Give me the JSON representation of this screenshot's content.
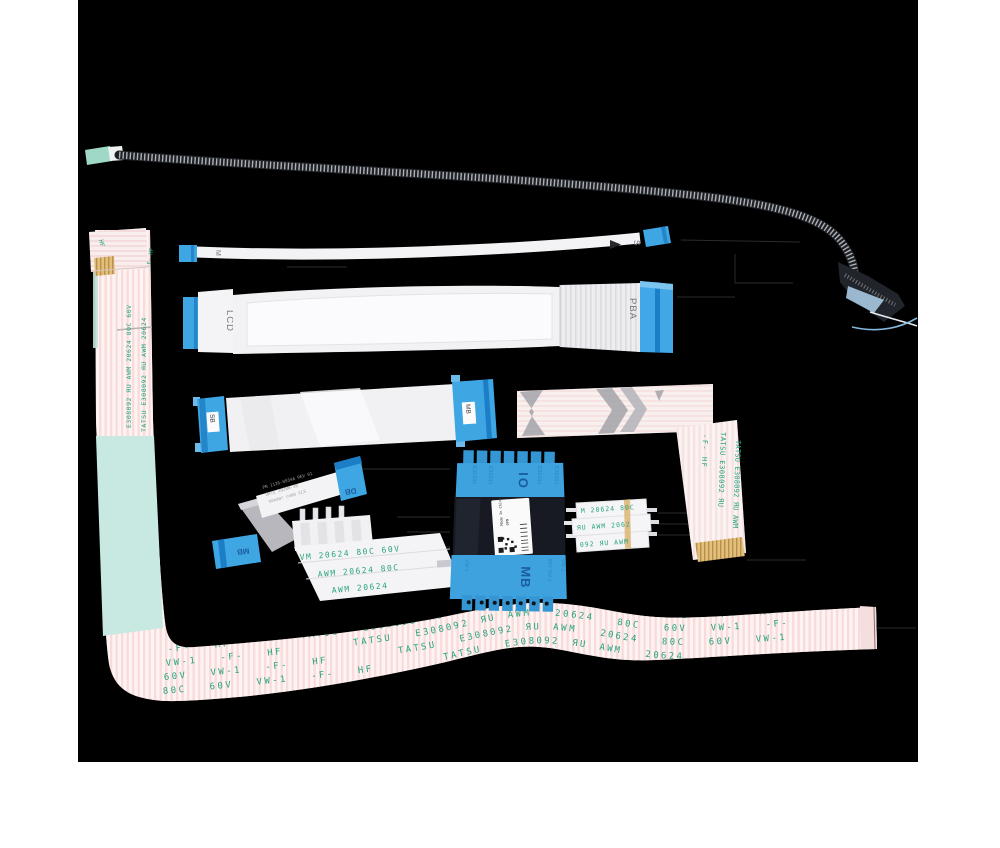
{
  "photo": {
    "background": "#000000",
    "canvas": "#ffffff"
  },
  "colors": {
    "connector_blue": "#3fa6e4",
    "connector_blue_dark": "#1b7ec6",
    "print_green": "#2aa37e",
    "deep_blue_print": "#174f92",
    "mesh_dark": "#1d2025",
    "teal_backing": "#c8e9e2",
    "pink_stripe": "#f6d2d2",
    "gold_contact": "#dfbd78"
  },
  "parts": {
    "thin_cable": {
      "left_marking": "M",
      "right_marking": "S",
      "arrow_glyph": "▶"
    },
    "display_cable": {
      "left_marking": "LCD",
      "right_marking": "PBA"
    },
    "mid_cable": {
      "left_label": "SB",
      "right_label": "MB"
    },
    "zfold_cable": {
      "top_label": "DB",
      "bottom_label": "MB",
      "print_lines": [
        "PN 1126-0934A REV 01",
        "DATE 2020W-30",
        "Vendor code CLS"
      ]
    },
    "pin_connector_cable": {
      "print_lines": [
        "VM 20624 80C 60V",
        "AWM 20624 80C",
        "AWM 20624"
      ]
    },
    "io_cable": {
      "top_marking": "IO",
      "bottom_marking": "MB",
      "edge_print": "E35341",
      "bottom_prints": [
        "VW-1",
        "60V VW-1",
        "VW-1"
      ],
      "label_lines": [
        "Made In China",
        "DPN"
      ]
    },
    "jumper_cable": {
      "print_lines": [
        "M 20624 80C",
        "ЯU AWM 2062",
        "092 ЯU AWM"
      ]
    },
    "l_cable": {
      "vertical_prints": [
        "-F- HF",
        "TATSU E308092 ЯU",
        "TATSU E308092 ЯU AWM"
      ]
    },
    "left_ribbon": {
      "flap_print": "HF",
      "corner_print": "-F- HF",
      "vertical_prints": [
        "E308092 ЯU AWM 20624 80C 60V",
        "TATSU E308092 ЯU AWM 20624"
      ]
    },
    "bottom_ribbon": {
      "rows": [
        "-F-  HF      TATSU  E308092 ЯU AWM  20624  80C  60V  VW-1  -F-  HF",
        "VW-1  -F-  HF      TATSU  E308092 ЯU AWM  20624  80C  60V  VW-1  -F-",
        "60V  VW-1  -F-  HF      TATSU  E308092 ЯU AWM  20624  80C  60V  VW-1",
        "80C  60V  VW-1  -F-  HF      TATSU  E308092 ЯU AWM  20624"
      ]
    }
  }
}
